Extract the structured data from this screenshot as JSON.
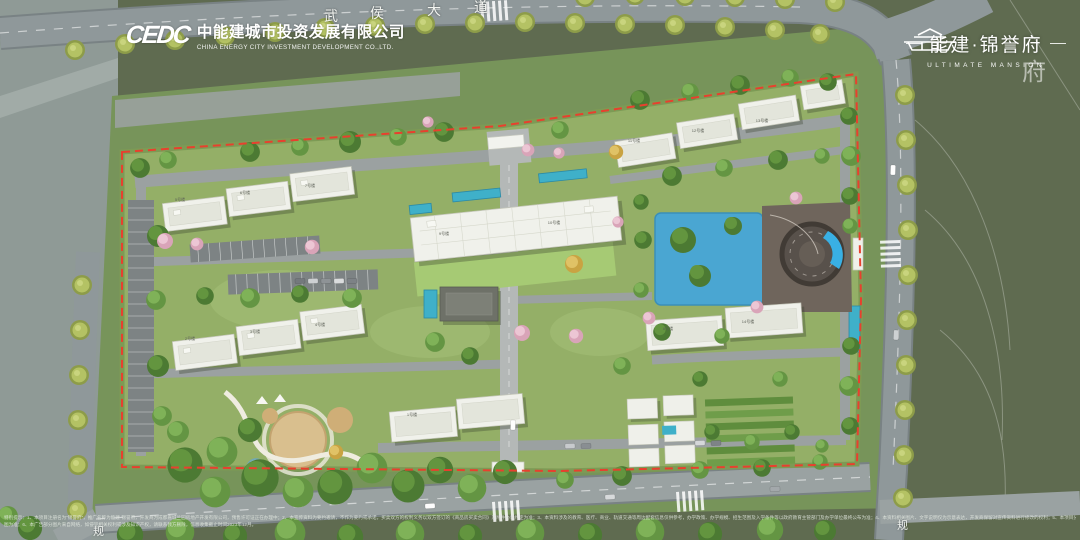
{
  "header": {
    "developer_logo_mark": "CEDC",
    "developer_name_cn": "中能建城市投资发展有限公司",
    "developer_name_en": "CHINA ENERGY CITY INVESTMENT DEVELOPMENT CO.,LTD.",
    "project_logo_cn": "能建·锦誉府",
    "project_logo_en": "ULTIMATE MANSION"
  },
  "map_labels": {
    "main_road_chars": [
      "武",
      "侯",
      "大",
      "道"
    ],
    "road_label_left": "规",
    "road_label_right": "规",
    "watermark": "府"
  },
  "building_labels": [
    "5号楼",
    "6号楼",
    "7号楼",
    "2号楼",
    "3号楼",
    "4号楼",
    "1号楼",
    "9号楼",
    "10号楼",
    "11号楼",
    "12号楼",
    "13号楼",
    "8号楼",
    "14号楼"
  ],
  "disclaimer": {
    "line1": "特别提示：1、本项目注册名为“锦誉府”，推广名称为能建·锦誉府，开发商为成都嘉城兰园房地产开发有限公司，预售许可证正在办理中；2、本宣传资料为要约邀请，不作为要约或承诺，买卖双方的权利义务以双方签订的《商品房买卖合同》及附件协议约定为准；3、本资料涉及的教育、医疗、商业、轨道交通等周边配套信息仅供参考，办学政策、办学规模、招生范围及入学条件等以政府教育主管部门及办学单位最终公布为准；4、本资料相关图片、文字说明仅为示意表达，开发商保留对宣传资料进行修改的权利；5、本项目分期开发建设，区域内展示的部分设施设备及园林景观为示意，最终以政府批准文件及实际交付的效果",
    "line2": "图为准；6、本广告部分图片来自网络，如侵犯相关权利或涉及知识产权，请联系我方删除，信息收集截止时间2023年12月。"
  },
  "palette": {
    "boundary_red": "#e8402e",
    "lawn_green": "#94af67",
    "tree_green": "#4c7a33",
    "street_tree_green": "#b4c264",
    "pool_blue": "#4aa6d2",
    "road_gray": "#8b9496",
    "field_olive": "#5f6b50",
    "building_white": "#f0f1eb",
    "deck_brown": "#6f655c",
    "blossom_pink": "#e0aec1"
  }
}
